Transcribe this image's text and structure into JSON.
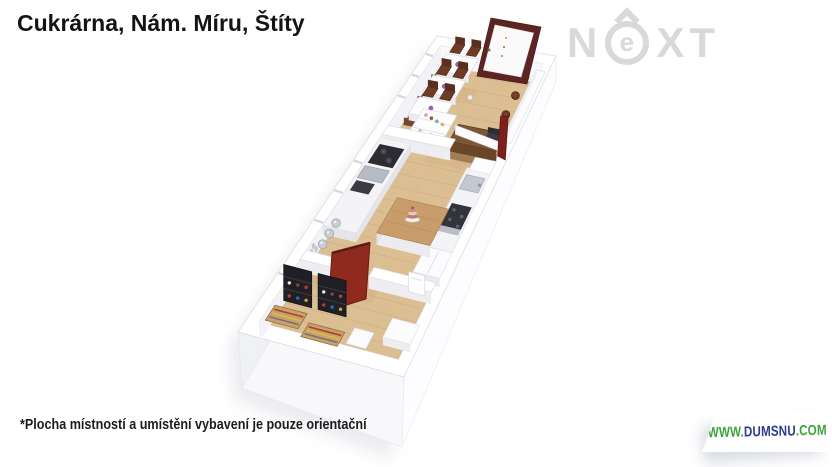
{
  "header": {
    "title": "Cukrárna, Nám. Míru, Štíty"
  },
  "logo": {
    "n": "N",
    "e": "e",
    "x": "X",
    "t": "T",
    "color": "#d9d9d9"
  },
  "footer": {
    "disclaimer": "*Plocha místností a umístění vybavení je pouze orientační",
    "website": {
      "prefix": "WWW.",
      "name": "DUMSNU",
      "suffix": ".COM",
      "prefix_color": "#3fa33c",
      "name_color": "#2b3a8f",
      "suffix_color": "#3fa33c"
    }
  },
  "floorplan": {
    "wall_color": "#ffffff",
    "floor_color": "#dcbe93",
    "plank_color": "#c9a47a",
    "entrance_door_color": "#5c2522",
    "interior_door_color": "#8e2a1e",
    "counter_color": "#7d5637",
    "chair_color": "#6d3b26",
    "shelf_color": "#1f1f25",
    "island_top_color": "#c99d6b",
    "cake_color": "#e9c9c3"
  }
}
